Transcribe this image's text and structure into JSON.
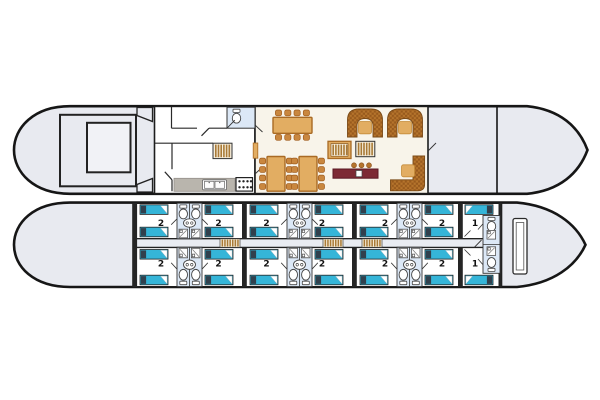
{
  "plan": {
    "type": "ship-deck-plan",
    "decks": 2
  },
  "colors": {
    "background": "#ffffff",
    "hull_fill": "#e8eaf0",
    "hull_outline": "#161616",
    "wall": "#252525",
    "cabin_floor": "#ffffff",
    "lounge_floor": "#f8f4ea",
    "bathroom_floor": "#dce8f6",
    "corridor_floor": "#e9ecf2",
    "bed_teal": "#35b5d8",
    "bed_pillow": "#31404d",
    "stairs_brown": "#a97a36",
    "wood_table": "#e2ad62",
    "wood_border": "#a96a24",
    "chair": "#c9873f",
    "sofa_check_a": "#b5742c",
    "sofa_check_b": "#985a1d",
    "bar_maroon": "#7d2a35",
    "counter_gray": "#b9b5ad"
  },
  "deck_upper": {
    "icons": [
      "wheelhouse",
      "skylight",
      "boarding-steps",
      "wc-toilet",
      "galley-staircase",
      "kitchen-counter",
      "double-sink",
      "stove",
      "sideboard",
      "dining-table-8-chairs",
      "dining-table-8-chairs",
      "dining-table-8-chairs",
      "lounge-staircase",
      "lounge-staircase",
      "arch-sofa",
      "arch-sofa",
      "coffee-table",
      "coffee-table",
      "coffee-table",
      "bar-counter",
      "bar-stools-x3",
      "corner-sofa"
    ]
  },
  "deck_lower": {
    "cabins_top": [
      "2",
      "2",
      "2",
      "2",
      "2",
      "2",
      "1"
    ],
    "cabins_bottom": [
      "2",
      "2",
      "2",
      "2",
      "2",
      "2",
      "1"
    ],
    "corridor_staircases": 3,
    "icons": [
      "double-bed",
      "toilet",
      "shower",
      "washbasin",
      "corridor",
      "bow-locker"
    ]
  }
}
